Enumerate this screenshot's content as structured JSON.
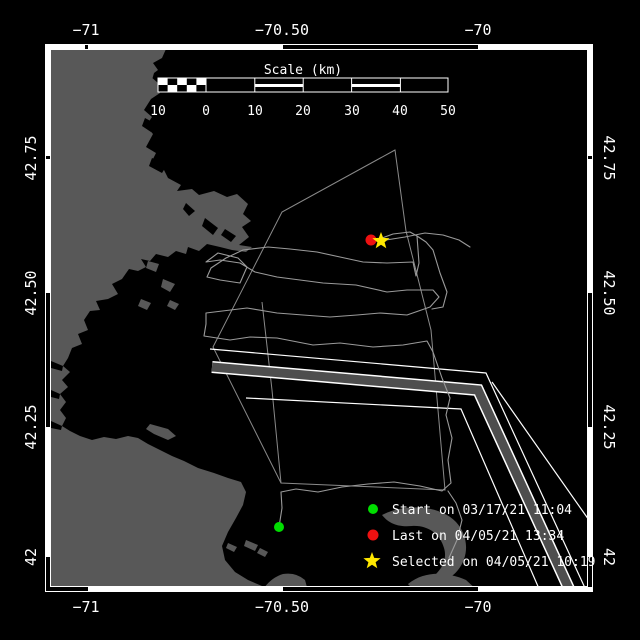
{
  "axes": {
    "lon_ticks": [
      "−71",
      "−70.50",
      "−70"
    ],
    "lat_ticks": [
      "42.75",
      "42.50",
      "42.25",
      "42"
    ]
  },
  "scale_bar": {
    "title": "Scale (km)",
    "tick_labels": [
      "10",
      "0",
      "10",
      "20",
      "30",
      "40",
      "50"
    ]
  },
  "legend": {
    "items": [
      {
        "marker": "start-dot",
        "label": "Start on 03/17/21 11:04"
      },
      {
        "marker": "last-dot",
        "label": "Last on 04/05/21 13:34"
      },
      {
        "marker": "selected-star",
        "label": "Selected on 04/05/21 10:19"
      }
    ]
  },
  "colors": {
    "background": "#000000",
    "land": "#585858",
    "water": "#000000",
    "frame": "#ffffff",
    "track": "#9a9a9a",
    "boundary": "#8a8a8a",
    "lane_stripe": "#4e4e4e",
    "start_marker": "#00dd00",
    "last_marker": "#ee1111",
    "selected_marker": "#ffe800",
    "text": "#ffffff"
  }
}
